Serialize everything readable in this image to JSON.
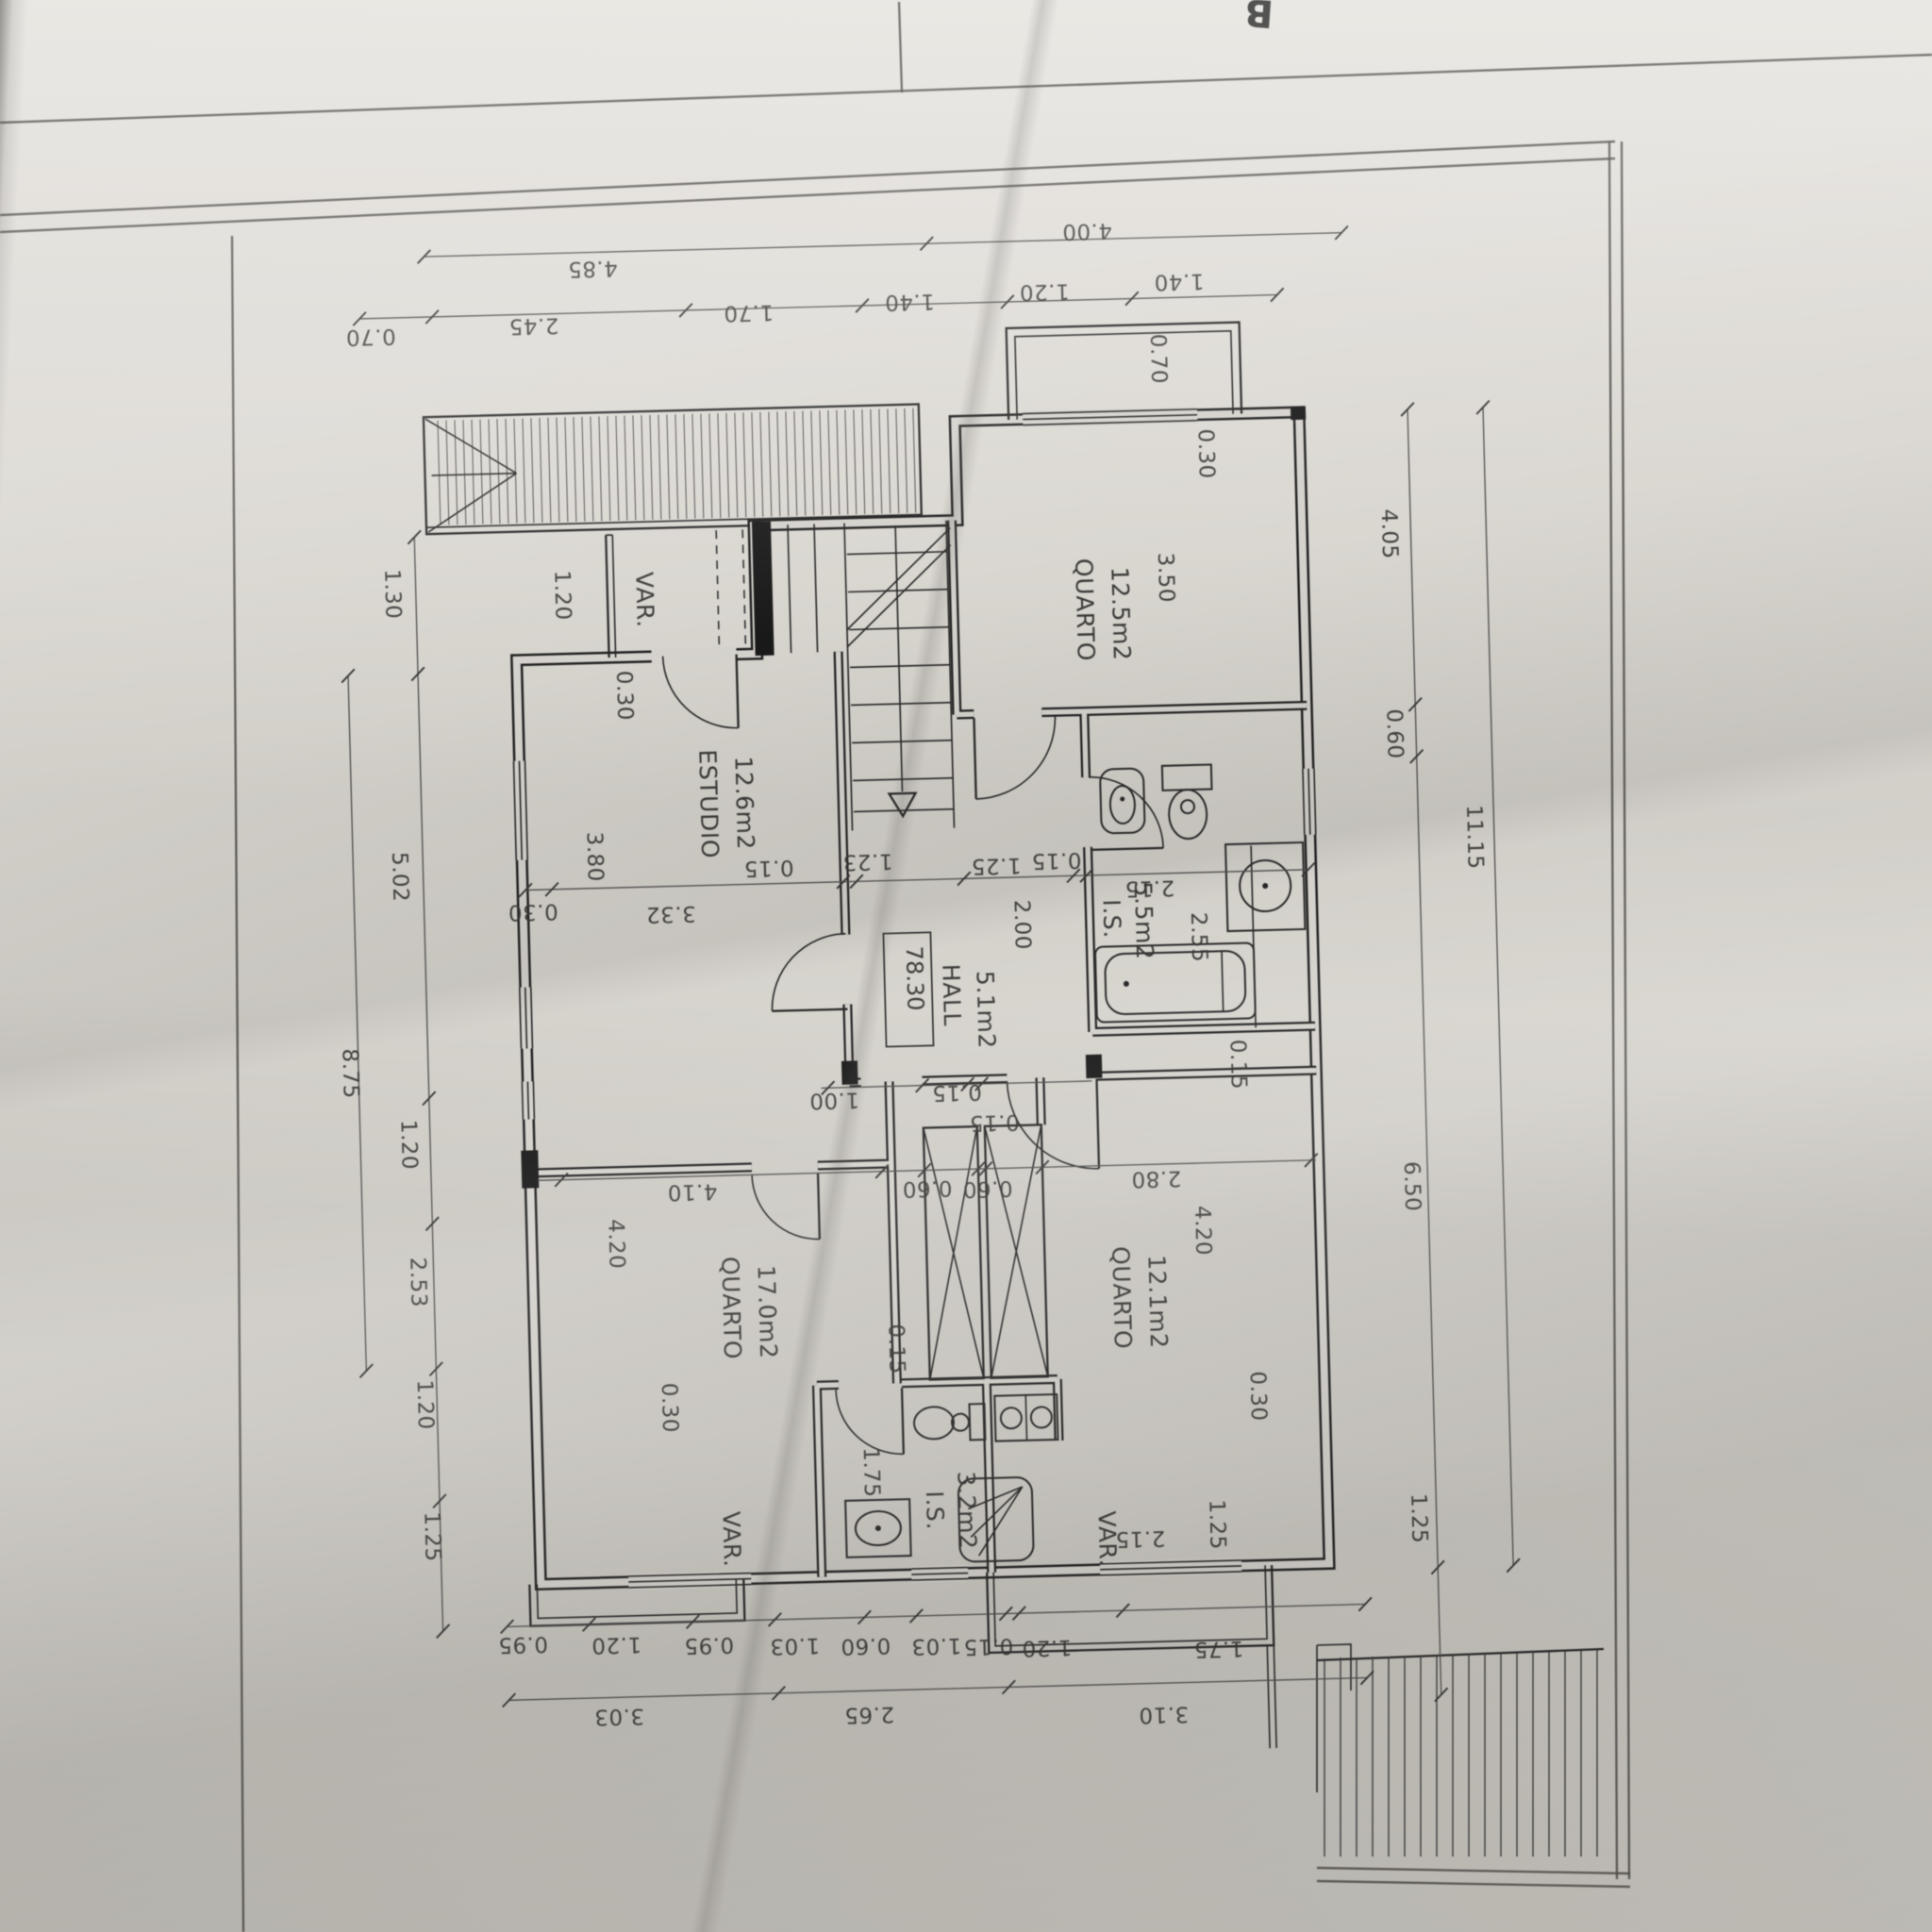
{
  "sheet": {
    "corner_mark": "B"
  },
  "rooms": {
    "estudio": {
      "name": "ESTUDIO",
      "area": "12.6m2"
    },
    "quarto_nw": {
      "name": "QUARTO",
      "area": "17.0m2"
    },
    "quarto_s": {
      "name": "QUARTO",
      "area": "12.1m2"
    },
    "quarto_ne": {
      "name": "QUARTO",
      "area": "12.5m2"
    },
    "hall": {
      "name": "HALL",
      "area": "5.1m2"
    },
    "is_main": {
      "name": "I.S.",
      "area": "5.5m2"
    },
    "is_small": {
      "name": "I.S.",
      "area": "3.2m2"
    },
    "var_top": {
      "name": "VAR."
    },
    "var_bottom_left": {
      "name": "VAR."
    },
    "var_bottom_right": {
      "name": "VAR."
    }
  },
  "level_marker": "78.30",
  "dims": {
    "top_outer": [
      "4.85",
      "4.00"
    ],
    "top_inner": [
      "0.70",
      "2.45",
      "1.70",
      "1.40",
      "1.20",
      "1.40"
    ],
    "left_outer": [
      "8.75"
    ],
    "left_inner": [
      "1.30",
      "5.02",
      "1.20",
      "2.53",
      "1.20",
      "1.25"
    ],
    "right_inner": [
      "4.05",
      "0.60",
      "6.50",
      "1.25"
    ],
    "right_outer": [
      "11.15"
    ],
    "bottom_row1": [
      "0.95",
      "1.20",
      "0.95",
      "1.03",
      "0.60",
      "1.03",
      "0.15",
      "1.20",
      "1.75"
    ],
    "bottom_row2": [
      "3.03",
      "2.65",
      "3.10"
    ],
    "estudio_line": [
      "0.30",
      "3.32",
      "0.15",
      "1.23",
      "1.25",
      "0.15",
      "2.15"
    ],
    "hall_line": [
      "1.00",
      "0.15"
    ],
    "mid_line": [
      "4.10",
      "0.60",
      "0.60",
      "2.80"
    ],
    "small_flipped": [
      "2.15",
      "0.15"
    ],
    "vertical": [
      "1.20",
      "0.30",
      "3.80",
      "0.70",
      "0.30",
      "3.50",
      "2.00",
      "2.55",
      "0.15",
      "4.20",
      "0.30",
      "0.15",
      "4.20",
      "0.30",
      "1.75",
      "1.25"
    ]
  }
}
